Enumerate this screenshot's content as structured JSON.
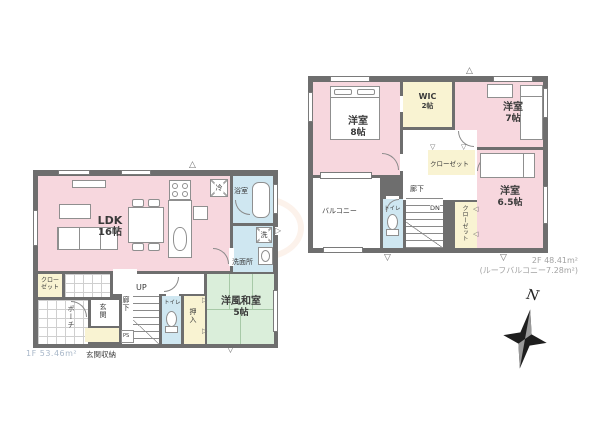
{
  "floor1": {
    "area_label": "1F 53.46m²",
    "rooms": {
      "ldk": {
        "name": "LDK",
        "size": "16帖"
      },
      "bath": {
        "name": "浴室"
      },
      "washroom": {
        "name": "洗面所"
      },
      "closet": {
        "line1": "クロー",
        "line2": "ゼット"
      },
      "porch": {
        "name": "ポーチ"
      },
      "genkan": {
        "name": "玄関"
      },
      "genkan_storage": {
        "name": "玄関収納"
      },
      "hallway": {
        "name": "廊下"
      },
      "stairs": {
        "label": "UP"
      },
      "ps": {
        "label": "PS"
      },
      "toilet": {
        "name": "トイレ"
      },
      "oshiire": {
        "name": "押入"
      },
      "washitsu": {
        "name": "洋風和室",
        "size": "5帖"
      }
    },
    "appliances": {
      "fridge": "冷",
      "washer": "洗"
    }
  },
  "floor2": {
    "area_label": "2F 48.41m²",
    "roof_balcony_label": "(ルーフバルコニー7.28m²)",
    "rooms": {
      "bedroom8": {
        "name": "洋室",
        "size": "8帖"
      },
      "wic": {
        "name": "WIC",
        "size": "2帖"
      },
      "bedroom7": {
        "name": "洋室",
        "size": "7帖"
      },
      "closet_upper": {
        "name": "クローゼット"
      },
      "closet_side": {
        "name": "クローゼット"
      },
      "bedroom65": {
        "name": "洋室",
        "size": "6.5帖"
      },
      "balcony": {
        "name": "バルコニー"
      },
      "hallway": {
        "name": "廊下"
      },
      "toilet": {
        "name": "トイレ"
      },
      "stairs": {
        "label": "DN"
      }
    }
  },
  "compass": {
    "north": "N"
  },
  "markers": {
    "up": "△",
    "down": "▽",
    "left": "◁",
    "right": "▷"
  },
  "watermark": "趣",
  "colors": {
    "wall": "#6e6e6e",
    "room_pink": "#f7d7de",
    "room_blue": "#cfe7f1",
    "room_yellow": "#f9f3d2",
    "room_green": "#daeeda",
    "area_text_1f": "#a9b8c9",
    "area_text_2f": "#a3a3a3",
    "watermark_orange": "#e28238"
  }
}
